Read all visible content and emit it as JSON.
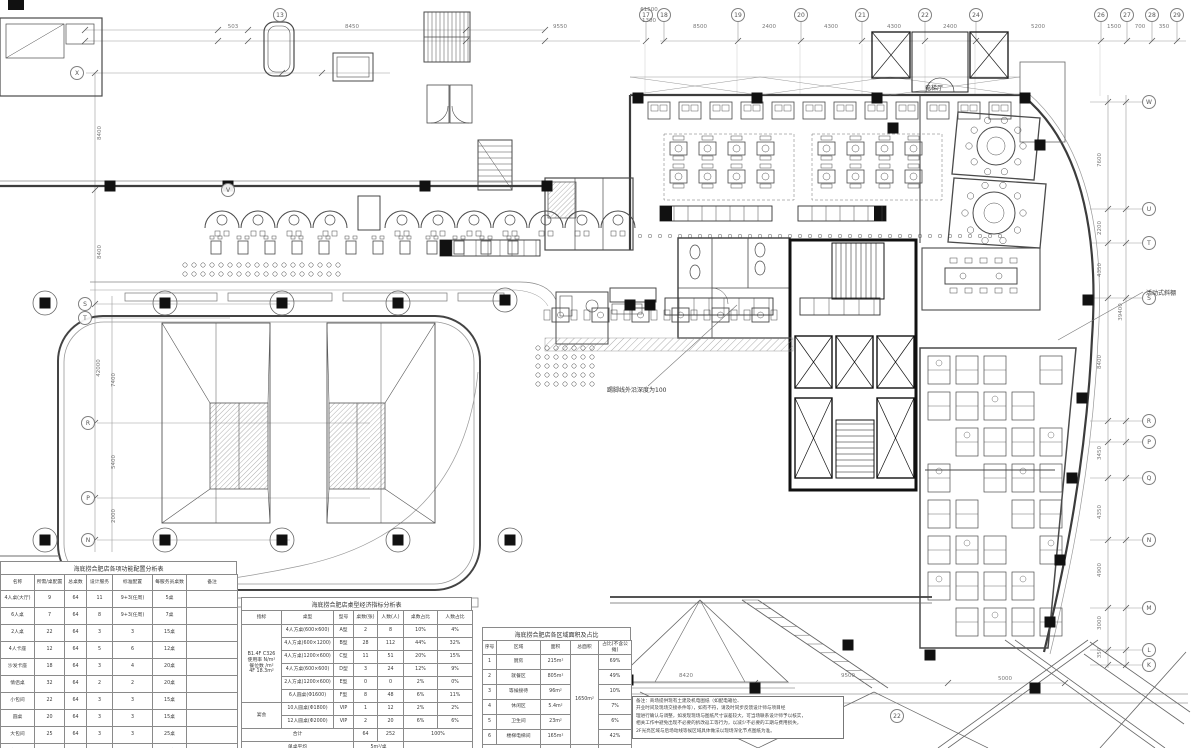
{
  "drawing": {
    "kind": "architectural floor plan (CAD, hot-pot restaurant level)",
    "line_color": "#4a4a4a",
    "accent_black": "#111111"
  },
  "annotations": [
    {
      "id": "elevator-hall-label",
      "text": "电梯厅",
      "x": 925,
      "y": 83
    },
    {
      "id": "movable-canopy-label",
      "text": "活动式斜棚",
      "x": 1146,
      "y": 288
    },
    {
      "id": "skirting-depth-label",
      "text": "踢脚线外沿深度为100",
      "x": 607,
      "y": 385
    }
  ],
  "grid_bubbles": [
    {
      "label": "17",
      "x": 646,
      "y": 15
    },
    {
      "label": "18",
      "x": 664,
      "y": 15
    },
    {
      "label": "13",
      "x": 280,
      "y": 15
    },
    {
      "label": "19",
      "x": 738,
      "y": 15
    },
    {
      "label": "20",
      "x": 801,
      "y": 15
    },
    {
      "label": "21",
      "x": 862,
      "y": 15
    },
    {
      "label": "22",
      "x": 925,
      "y": 15
    },
    {
      "label": "24",
      "x": 976,
      "y": 15
    },
    {
      "label": "26",
      "x": 1101,
      "y": 15
    },
    {
      "label": "27",
      "x": 1127,
      "y": 15
    },
    {
      "label": "28",
      "x": 1152,
      "y": 15
    },
    {
      "label": "29",
      "x": 1177,
      "y": 15
    },
    {
      "label": "X",
      "x": 77,
      "y": 73
    },
    {
      "label": "V",
      "x": 228,
      "y": 190
    },
    {
      "label": "S",
      "x": 85,
      "y": 304
    },
    {
      "label": "T",
      "x": 85,
      "y": 318
    },
    {
      "label": "R",
      "x": 88,
      "y": 423
    },
    {
      "label": "P",
      "x": 88,
      "y": 498
    },
    {
      "label": "N",
      "x": 88,
      "y": 540
    },
    {
      "label": "W",
      "x": 1149,
      "y": 102
    },
    {
      "label": "U",
      "x": 1149,
      "y": 209
    },
    {
      "label": "T",
      "x": 1149,
      "y": 243
    },
    {
      "label": "S",
      "x": 1149,
      "y": 298
    },
    {
      "label": "R",
      "x": 1149,
      "y": 421
    },
    {
      "label": "P",
      "x": 1149,
      "y": 442
    },
    {
      "label": "Q",
      "x": 1149,
      "y": 478
    },
    {
      "label": "N",
      "x": 1149,
      "y": 540
    },
    {
      "label": "M",
      "x": 1149,
      "y": 608
    },
    {
      "label": "L",
      "x": 1149,
      "y": 650
    },
    {
      "label": "K",
      "x": 1149,
      "y": 665
    },
    {
      "label": "22",
      "x": 897,
      "y": 716
    }
  ],
  "dimensions": [
    {
      "text": "503",
      "x": 233,
      "y": 27
    },
    {
      "text": "8450",
      "x": 352,
      "y": 27
    },
    {
      "text": "9550",
      "x": 560,
      "y": 27
    },
    {
      "text": "61500",
      "x": 649,
      "y": 10
    },
    {
      "text": "1300",
      "x": 649,
      "y": 21
    },
    {
      "text": "8500",
      "x": 700,
      "y": 27
    },
    {
      "text": "2400",
      "x": 769,
      "y": 27
    },
    {
      "text": "4300",
      "x": 831,
      "y": 27
    },
    {
      "text": "4300",
      "x": 894,
      "y": 27
    },
    {
      "text": "2400",
      "x": 950,
      "y": 27
    },
    {
      "text": "5200",
      "x": 1038,
      "y": 27
    },
    {
      "text": "1500",
      "x": 1114,
      "y": 27
    },
    {
      "text": "700",
      "x": 1140,
      "y": 27
    },
    {
      "text": "350",
      "x": 1164,
      "y": 27
    },
    {
      "text": "8400",
      "x": 100,
      "y": 133,
      "rot": true
    },
    {
      "text": "8400",
      "x": 100,
      "y": 252,
      "rot": true
    },
    {
      "text": "42000",
      "x": 99,
      "y": 368,
      "rot": true
    },
    {
      "text": "7400",
      "x": 114,
      "y": 380,
      "rot": true
    },
    {
      "text": "5400",
      "x": 114,
      "y": 462,
      "rot": true
    },
    {
      "text": "2000",
      "x": 114,
      "y": 516,
      "rot": true
    },
    {
      "text": "7600",
      "x": 1100,
      "y": 160,
      "rot": true
    },
    {
      "text": "2200",
      "x": 1100,
      "y": 228,
      "rot": true
    },
    {
      "text": "4350",
      "x": 1100,
      "y": 270,
      "rot": true
    },
    {
      "text": "8400",
      "x": 1100,
      "y": 362,
      "rot": true
    },
    {
      "text": "39400",
      "x": 1121,
      "y": 312,
      "rot": true
    },
    {
      "text": "3450",
      "x": 1100,
      "y": 453,
      "rot": true
    },
    {
      "text": "4350",
      "x": 1100,
      "y": 512,
      "rot": true
    },
    {
      "text": "4900",
      "x": 1100,
      "y": 570,
      "rot": true
    },
    {
      "text": "3000",
      "x": 1100,
      "y": 623,
      "rot": true
    },
    {
      "text": "350",
      "x": 1100,
      "y": 653,
      "rot": true
    },
    {
      "text": "8420",
      "x": 686,
      "y": 676
    },
    {
      "text": "9500",
      "x": 848,
      "y": 676
    },
    {
      "text": "5000",
      "x": 1005,
      "y": 679
    }
  ],
  "tables": {
    "function_analysis": {
      "pos": {
        "left": 0,
        "top": 561,
        "width": 237
      },
      "title": "海底捞合肥店各项功能配置分析表",
      "widths": [
        34,
        30,
        22,
        26,
        40,
        34,
        51
      ],
      "headers": [
        "名称",
        "所需/桌配置",
        "总桌数",
        "设计服务",
        "标准配置",
        "每服务员桌数",
        "备注"
      ],
      "rows": [
        [
          "4人桌(大厅)",
          "9",
          "64",
          "11",
          "9+3(任周)",
          "5桌",
          ""
        ],
        [
          "6人桌",
          "7",
          "64",
          "8",
          "9+3(任周)",
          "7桌",
          ""
        ],
        [
          "2人桌",
          "22",
          "64",
          "3",
          "3",
          "15桌",
          ""
        ],
        [
          "4人卡座",
          "12",
          "64",
          "5",
          "6",
          "12桌",
          ""
        ],
        [
          "沙发卡座",
          "18",
          "64",
          "3",
          "4",
          "20桌",
          ""
        ],
        [
          "情侣桌",
          "32",
          "64",
          "2",
          "2",
          "20桌",
          ""
        ],
        [
          "小包间",
          "22",
          "64",
          "3",
          "3",
          "15桌",
          ""
        ],
        [
          "圆桌",
          "20",
          "64",
          "3",
          "3",
          "15桌",
          ""
        ],
        [
          "大包间",
          "25",
          "64",
          "3",
          "3",
          "25桌",
          ""
        ],
        [
          "宴会厅",
          "90",
          "64",
          "1",
          "1",
          "50桌",
          ""
        ],
        [
          {
            "t": "合计",
            "cs": 2
          },
          null,
          "",
          "",
          "",
          "",
          ""
        ]
      ]
    },
    "table_type_metrics": {
      "pos": {
        "left": 241,
        "top": 597,
        "width": 231
      },
      "title": "海底捞合肥店桌型经济指标分析表",
      "widths": [
        40,
        52,
        20,
        24,
        26,
        34,
        35
      ],
      "headers": [
        "指标",
        "桌型",
        "型号",
        "桌数(张)",
        "人数(人)",
        "桌数占比",
        "人数占比"
      ],
      "rows": [
        [
          {
            "t": "B1.4F C326\n使用率 N/m²\n餐位数 /m²\n4F 18.3m²",
            "rs": 6
          },
          "4人方桌(600×600)",
          "A型",
          "2",
          "8",
          "10%",
          "4%"
        ],
        [
          null,
          "4人方桌(600×1200)",
          "B型",
          "28",
          "112",
          "44%",
          "32%"
        ],
        [
          null,
          "4人方桌(1200×600)",
          "C型",
          "11",
          "51",
          "20%",
          "15%"
        ],
        [
          null,
          "4人方桌(600×600)",
          "D型",
          "3",
          "24",
          "12%",
          "9%"
        ],
        [
          null,
          "2人方桌(1200×600)",
          "E型",
          "0",
          "0",
          "2%",
          "0%"
        ],
        [
          null,
          "6人圆桌(Φ1600)",
          "F型",
          "8",
          "48",
          "6%",
          "11%"
        ],
        [
          {
            "t": "宴会",
            "rs": 2
          },
          "10人圆桌(Φ1800)",
          "VIP",
          "1",
          "12",
          "2%",
          "2%"
        ],
        [
          null,
          "12人圆桌(Φ2000)",
          "VIP",
          "2",
          "20",
          "6%",
          "6%"
        ],
        [
          {
            "t": "合计",
            "cs": 3
          },
          null,
          null,
          "64",
          "252",
          {
            "t": "100%",
            "cs": 2
          },
          null
        ],
        [
          {
            "t": "单桌平均",
            "cs": 3
          },
          null,
          null,
          {
            "t": "5m²/桌",
            "cs": 2
          },
          null,
          {
            "t": "",
            "cs": 2
          },
          null
        ],
        [
          {
            "t": "人均指标",
            "cs": 3
          },
          null,
          null,
          {
            "t": "2.0m²/人",
            "cs": 2
          },
          null,
          {
            "t": "",
            "cs": 2
          },
          null
        ]
      ]
    },
    "area_breakdown": {
      "pos": {
        "left": 482,
        "top": 627,
        "width": 149
      },
      "title": "海底捞合肥店各区域面积及占比",
      "widths": [
        14,
        44,
        30,
        28,
        33
      ],
      "headers": [
        "序号",
        "区域",
        "面积",
        "总面积",
        "占比(不含公摊)"
      ],
      "rows": [
        [
          "1",
          "厨房",
          "215m²",
          {
            "t": "1650m²",
            "rs": 6
          },
          "69%"
        ],
        [
          "2",
          "就餐区",
          "805m²",
          null,
          "49%"
        ],
        [
          "3",
          "等候接待",
          "96m²",
          null,
          "10%"
        ],
        [
          "4",
          "休闲区",
          "5.4m²",
          null,
          "7%"
        ],
        [
          "5",
          "卫生间",
          "23m²",
          null,
          "6%"
        ],
        [
          "6",
          "楼梯电梯间",
          "165m²",
          null,
          "42%"
        ],
        [
          {
            "t": "合计",
            "cs": 2
          },
          null,
          "",
          "",
          ""
        ]
      ]
    }
  },
  "notes": {
    "pos": {
      "left": 632,
      "top": 696,
      "width": 204
    },
    "lines": [
      "备注：商场提供现有土建及机电图纸（如配电箱位、",
      "开业时间及现场交接条件等），如有不符，请及时同步反馈设计师与项目经",
      "理进行确认与调整，如发现现场与图纸尺寸误差较大，可当场联系设计师予以核实，",
      "相关工作中避免出现不必要的拆改返工等行为，以减少不必要的工期与费用损失，",
      "2F光亮区域与后场动线等候区域具体做法以现场深化节点图纸为准。"
    ]
  }
}
